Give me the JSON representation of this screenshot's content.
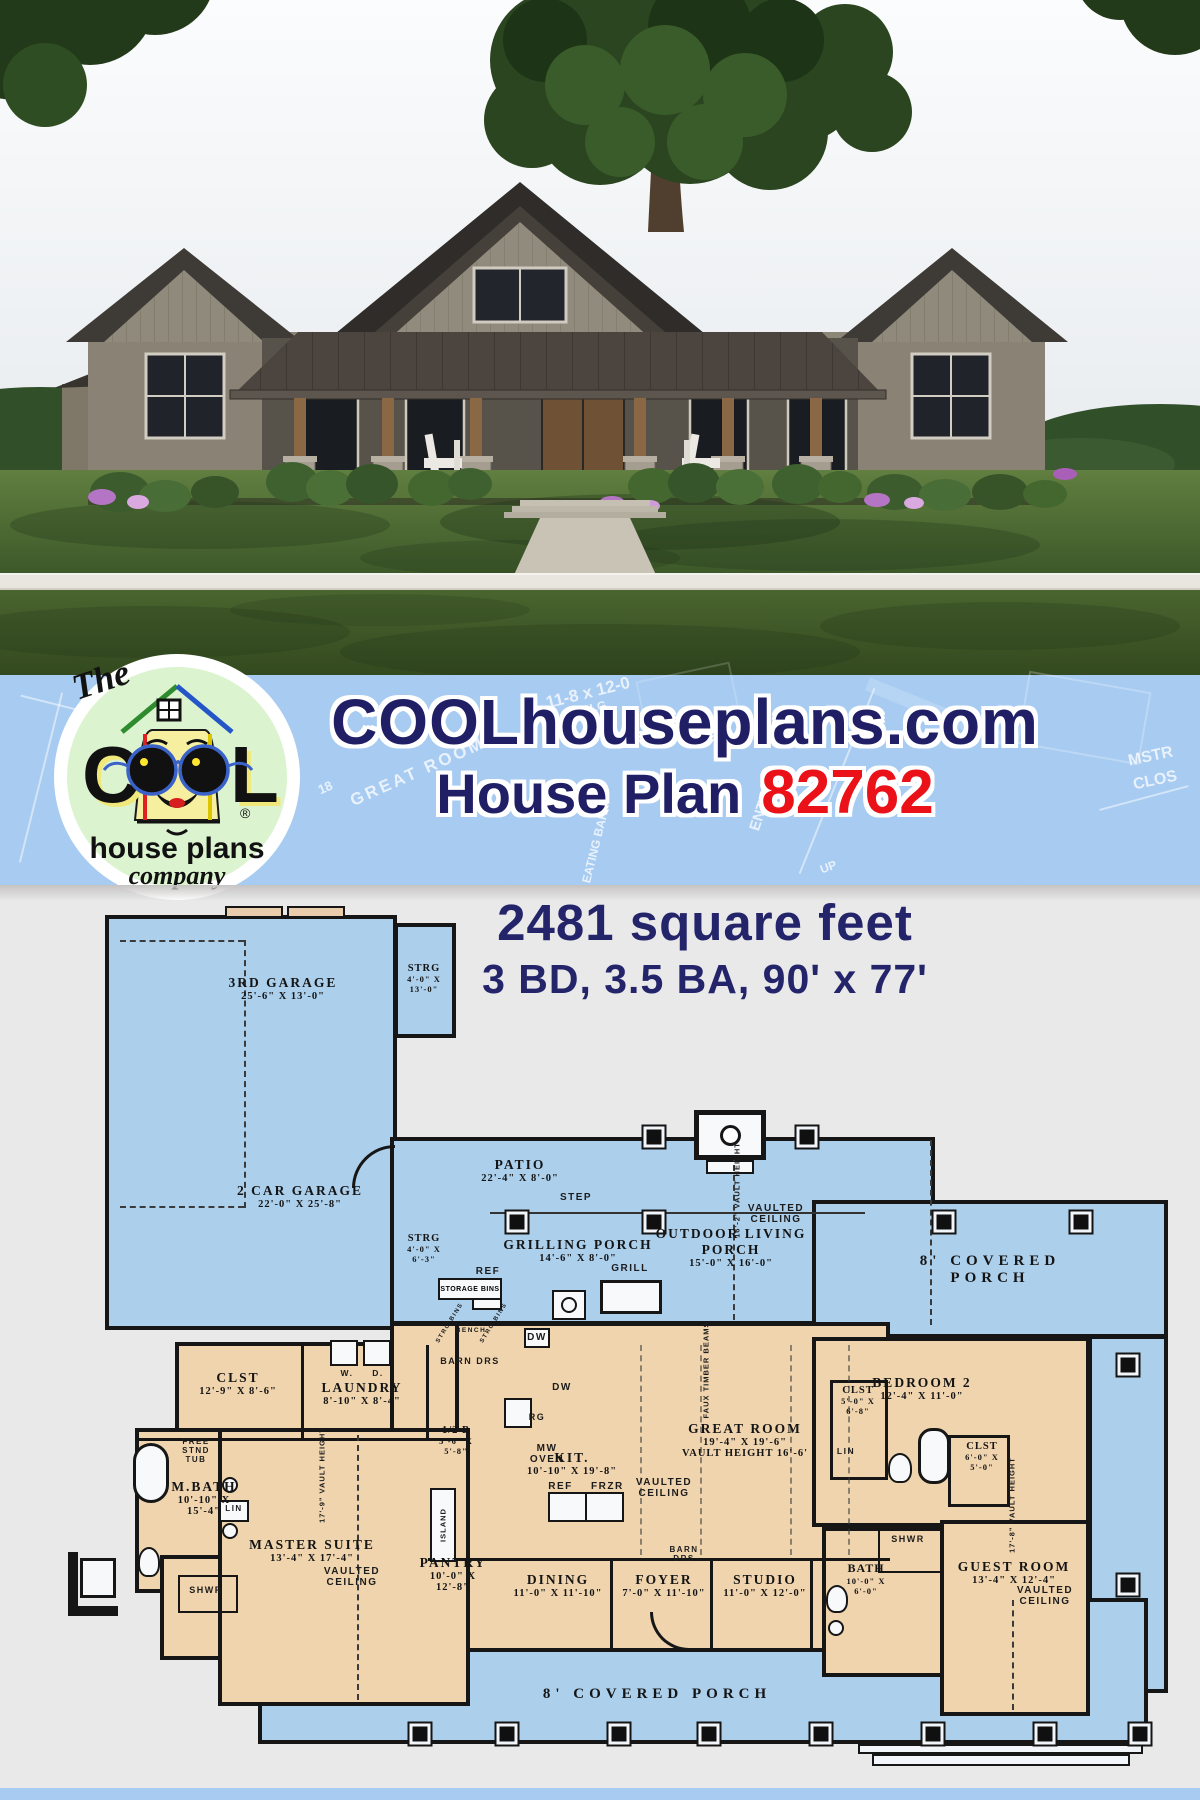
{
  "banner": {
    "site_title": "COOLhouseplans.com",
    "plan_label": "House Plan",
    "plan_number": "82762",
    "logo": {
      "the": "The",
      "c": "C",
      "l": "L",
      "house_plans": "house plans",
      "company": "company",
      "registered": "®"
    },
    "watermarks": [
      "11-8 x 12-0",
      "10' CLG",
      "GREAT ROOM",
      "18",
      "EATING BAR",
      "ENTRY",
      "MSTR",
      "CLOS",
      "UP",
      "HT."
    ]
  },
  "stats": {
    "area": "2481 square feet",
    "specs": "3 BD, 3.5 BA, 90' x 77'"
  },
  "plan": {
    "rooms": {
      "garage3": {
        "name": "3RD GARAGE",
        "dims": "25'-6\" X 13'-0\""
      },
      "strg_top": {
        "name": "STRG",
        "d1": "4'-0\" X",
        "d2": "13'-0\""
      },
      "garage2": {
        "name": "2 CAR GARAGE",
        "dims": "22'-0\" X 25'-8\""
      },
      "strg_mid": {
        "name": "STRG",
        "d1": "4'-0\" X",
        "d2": "6'-3\""
      },
      "patio": {
        "name": "PATIO",
        "dims": "22'-4\" X 8'-0\""
      },
      "grilling_porch": {
        "name": "GRILLING PORCH",
        "dims": "14'-6\" X 8'-0\""
      },
      "outdoor_living": {
        "line1": "OUTDOOR LIVING",
        "line2": "PORCH",
        "dims": "15'-0\" X 16'-0\""
      },
      "covered_porch": {
        "name": "8' COVERED PORCH"
      },
      "clst_left": {
        "name": "CLST",
        "dims": "12'-9\" X 8'-6\""
      },
      "laundry": {
        "name": "LAUNDRY",
        "dims": "8'-10\" X 8'-4\""
      },
      "half_bath": {
        "name": "1/2 B",
        "d1": "5'-6\" X",
        "d2": "5'-8\""
      },
      "mbath": {
        "name": "M.BATH",
        "d1": "10'-10\" X",
        "d2": "15'-4\""
      },
      "master": {
        "name": "MASTER SUITE",
        "dims": "13'-4\" X 17'-4\""
      },
      "pantry": {
        "name": "PANTRY",
        "d1": "10'-0\" X",
        "d2": "12'-8\""
      },
      "kitchen": {
        "name": "KIT.",
        "dims": "10'-10\" X 19'-8\""
      },
      "great_room": {
        "name": "GREAT ROOM",
        "dims": "19'-4\" X 19'-6\"",
        "vault": "VAULT HEIGHT 16'-6'"
      },
      "dining": {
        "name": "DINING",
        "dims": "11'-0\" X 11'-10\""
      },
      "foyer": {
        "name": "FOYER",
        "dims": "7'-0\" X 11'-10\""
      },
      "studio": {
        "name": "STUDIO",
        "dims": "11'-0\" X 12'-0\""
      },
      "bedroom2": {
        "name": "BEDROOM 2",
        "dims": "12'-4\" X 11'-0\""
      },
      "clst_bed2": {
        "name": "CLST",
        "d1": "5'-0\" X",
        "d2": "6'-8\""
      },
      "clst_guest": {
        "name": "CLST",
        "d1": "6'-0\" X",
        "d2": "5'-0\""
      },
      "bath_right": {
        "name": "BATH",
        "d1": "10'-0\" X",
        "d2": "6'-0\""
      },
      "guest": {
        "name": "GUEST ROOM",
        "dims": "13'-4\" X 12'-4\""
      }
    },
    "annotations": {
      "step": "STEP",
      "vaulted": "VAULTED",
      "ceiling": "CEILING",
      "barn_drs": "BARN DRS",
      "barn": "BARN",
      "drs": "DRS",
      "storage_bins": "STORAGE BINS",
      "strg_bins": "STRG BINS",
      "bench": "BENCH",
      "ref": "REF",
      "frzr": "FRZR",
      "grill": "GRILL",
      "dw": "DW",
      "rg": "RG",
      "mw": "MW",
      "oven": "OVEN",
      "island": "ISLAND",
      "w": "W.",
      "d": "D.",
      "lin": "LIN",
      "shwr": "SHWR",
      "tub": "FREE STND TUB",
      "faux_timber": "FAUX TIMBER BEAMS",
      "vault_height_outdoor": "16'-2\" VAULT HEIGHT",
      "vault_height_master": "17'-9\" VAULT HEIGHT",
      "vault_height_guest": "17'-8\" VAULT HEIGHT"
    }
  },
  "theme": {
    "banner_blue": "#a7cbf1",
    "navy": "#201f66",
    "red": "#ea1118",
    "porch_blue": "#accfec",
    "room_tan": "#f0d4ae",
    "wall": "#161616",
    "bg_gray": "#e9e9ea",
    "logo_green": "#dcf3d0",
    "logo_yellow": "#f6ef9f"
  }
}
